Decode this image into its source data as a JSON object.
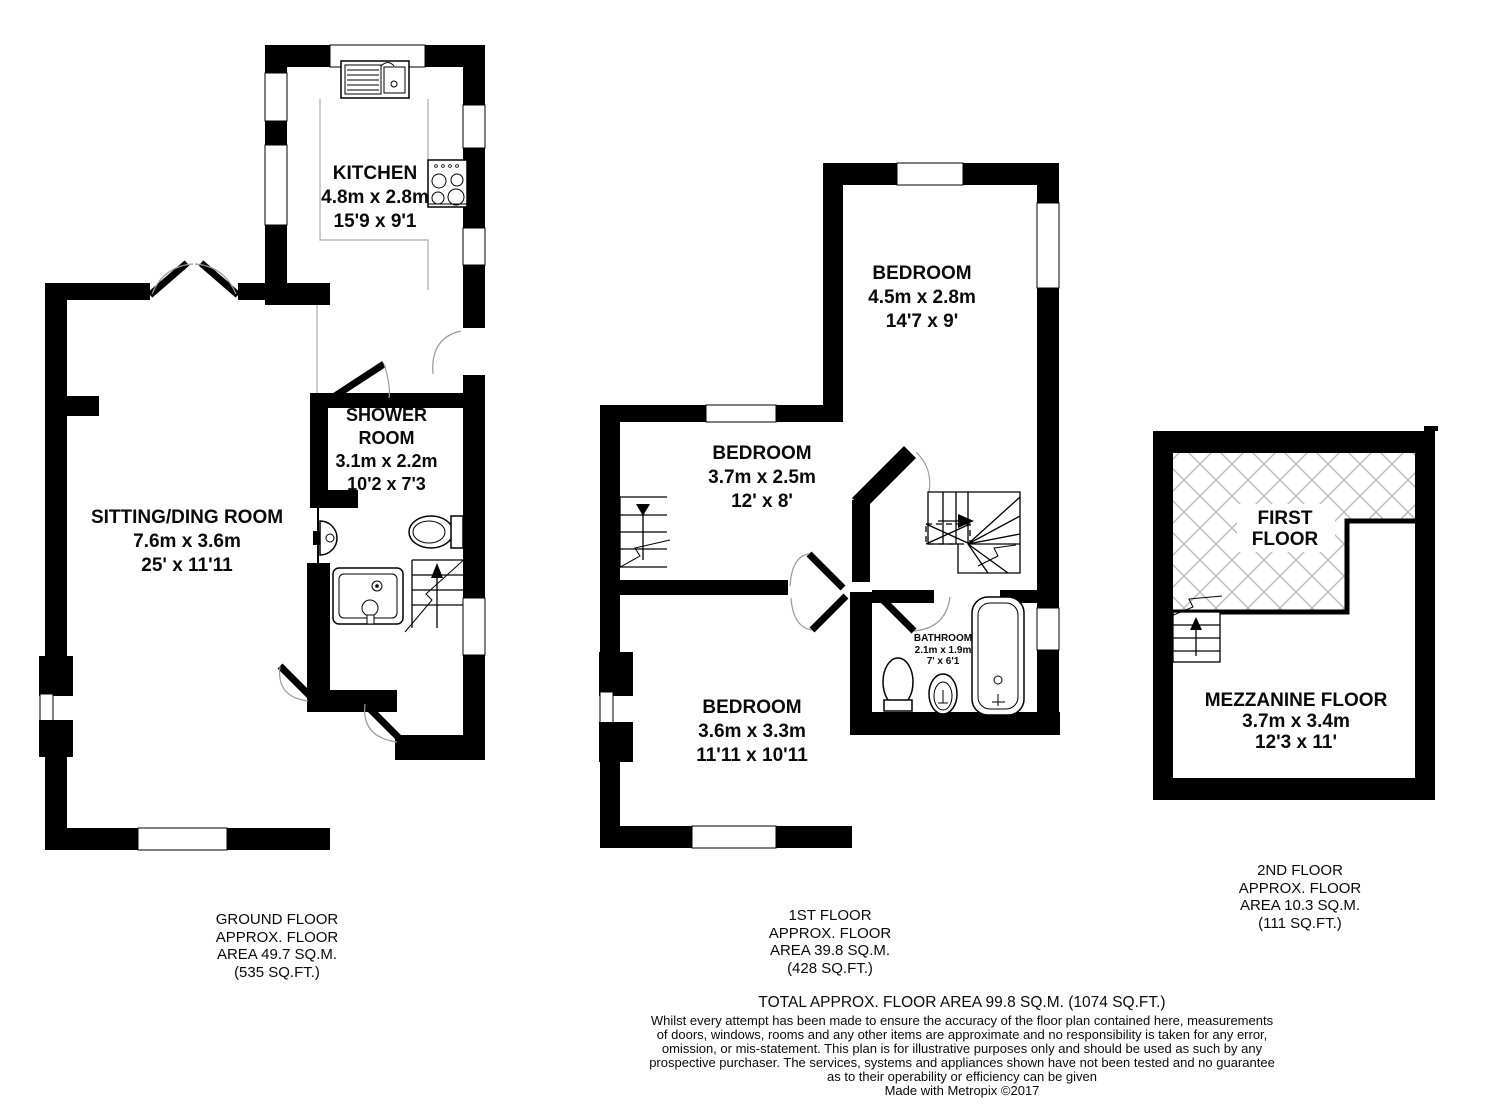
{
  "ground_floor": {
    "caption_lines": [
      "GROUND FLOOR",
      "APPROX. FLOOR",
      "AREA 49.7 SQ.M.",
      "(535 SQ.FT.)"
    ],
    "rooms": {
      "kitchen": {
        "name": "KITCHEN",
        "size_metric": "4.8m x 2.8m",
        "size_imperial": "15'9 x 9'1"
      },
      "sitting_dining": {
        "name": "SITTING/DING ROOM",
        "size_metric": "7.6m x 3.6m",
        "size_imperial": "25' x 11'11"
      },
      "shower_room": {
        "name_line1": "SHOWER",
        "name_line2": "ROOM",
        "size_metric": "3.1m x 2.2m",
        "size_imperial": "10'2 x 7'3"
      }
    }
  },
  "first_floor": {
    "caption_lines": [
      "1ST FLOOR",
      "APPROX. FLOOR",
      "AREA 39.8 SQ.M.",
      "(428 SQ.FT.)"
    ],
    "rooms": {
      "bedroom_large": {
        "name": "BEDROOM",
        "size_metric": "4.5m x 2.8m",
        "size_imperial": "14'7 x 9'"
      },
      "bedroom_mid": {
        "name": "BEDROOM",
        "size_metric": "3.7m x 2.5m",
        "size_imperial": "12' x 8'"
      },
      "bedroom_lower": {
        "name": "BEDROOM",
        "size_metric": "3.6m x 3.3m",
        "size_imperial": "11'11 x 10'11"
      },
      "bathroom": {
        "name": "BATHROOM",
        "size_metric": "2.1m x 1.9m",
        "size_imperial": "7' x 6'1"
      }
    }
  },
  "second_floor": {
    "caption_lines": [
      "2ND FLOOR",
      "APPROX. FLOOR",
      "AREA 10.3 SQ.M.",
      "(111 SQ.FT.)"
    ],
    "rooms": {
      "first_floor_void": {
        "name_line1": "FIRST",
        "name_line2": "FLOOR"
      },
      "mezzanine": {
        "name": "MEZZANINE FLOOR",
        "size_metric": "3.7m x 3.4m",
        "size_imperial": "12'3 x 11'"
      }
    }
  },
  "summary": {
    "total_area": "TOTAL APPROX. FLOOR AREA 99.8 SQ.M. (1074 SQ.FT.)",
    "disclaimer_lines": [
      "Whilst every attempt has been made to ensure the accuracy of the floor plan contained here, measurements",
      "of doors, windows, rooms and any other items are approximate and no responsibility is taken for any error,",
      "omission, or mis-statement. This plan is for illustrative purposes only and should be used as such by any",
      "prospective purchaser. The services, systems and appliances shown have not been tested and no guarantee",
      "as to their operability or efficiency can be given"
    ],
    "credit": "Made with Metropix ©2017"
  },
  "colors": {
    "wall": "#000000",
    "hatch_line": "#b9b9b9",
    "fixture_line": "#9a9a9a"
  }
}
